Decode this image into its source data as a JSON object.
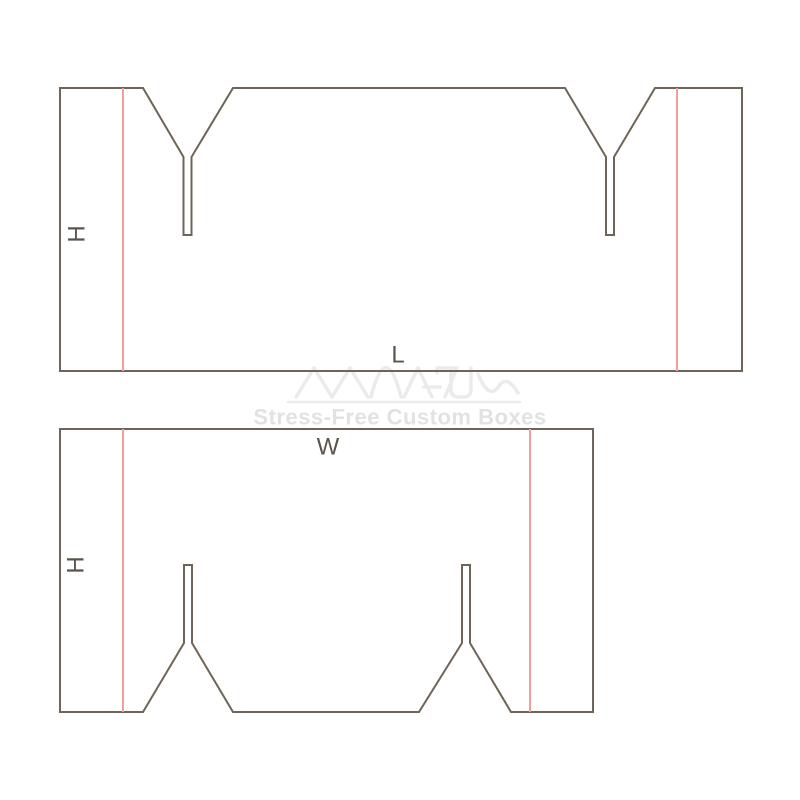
{
  "canvas": {
    "width": 800,
    "height": 800,
    "background": "#ffffff"
  },
  "colors": {
    "cut_line": "#6e6458",
    "fold_line": "#f59c9c",
    "dimension_label": "#5c544a",
    "watermark_logo": "#ebebeb",
    "watermark_text": "#e2e2e2"
  },
  "watermark": {
    "logo": "maxus-wave-logo",
    "tagline": "Stress-Free Custom Boxes"
  },
  "panels": [
    {
      "name": "length-panel",
      "outline": "60,371 60,88 143,88 183.5,157 183.5,235 191.5,235 191.5,157 233,88 565,88 606,157 606,235 614,235 614,157 655,88 742,88 742,371",
      "fold_lines": [
        {
          "x": 123,
          "y1": 88,
          "y2": 371
        },
        {
          "x": 677,
          "y1": 88,
          "y2": 371
        }
      ],
      "labels": [
        {
          "text": "H",
          "x": 77,
          "y": 234,
          "rotate": -90
        },
        {
          "text": "L",
          "x": 398,
          "y": 355,
          "rotate": 0
        }
      ]
    },
    {
      "name": "width-panel",
      "outline": "60,429 593,429 593,712 511,712 470,643 470,565 462,565 462,643 419,712 233,712 192,643 192,565 184,565 184,643 143,712 60,712",
      "fold_lines": [
        {
          "x": 123,
          "y1": 429,
          "y2": 712
        },
        {
          "x": 530,
          "y1": 429,
          "y2": 712
        }
      ],
      "labels": [
        {
          "text": "H",
          "x": 76,
          "y": 565,
          "rotate": -90
        },
        {
          "text": "W",
          "x": 328,
          "y": 447,
          "rotate": 0
        }
      ]
    }
  ]
}
